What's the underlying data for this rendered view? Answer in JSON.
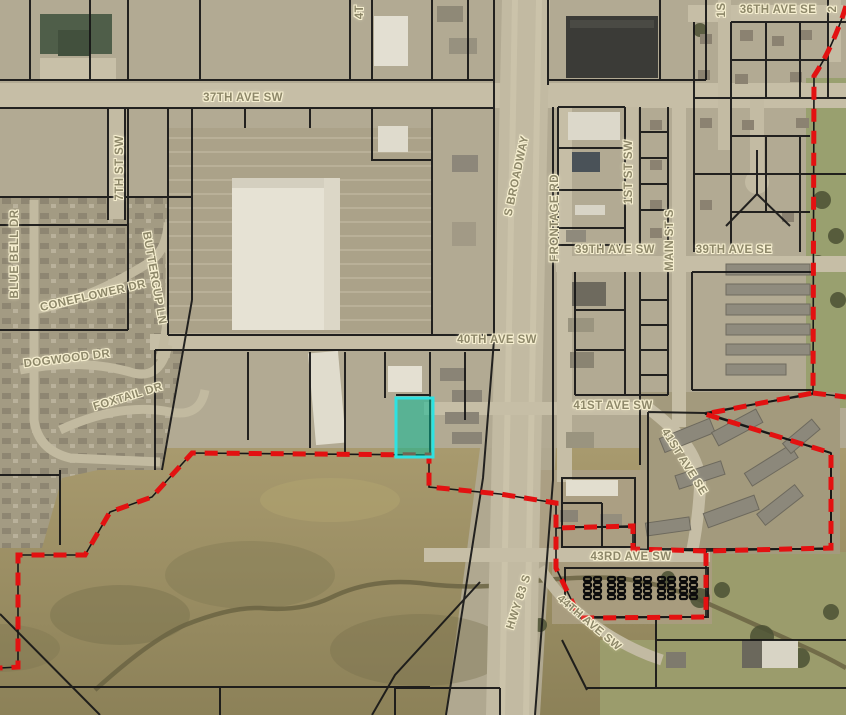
{
  "map": {
    "type": "parcel-aerial-map",
    "highlight_parcel": {
      "description": "selected parcel highlighted in cyan",
      "stroke_color": "#2ee2e2",
      "fill_color": "rgba(0,185,150,0.5)"
    },
    "boundary": {
      "description": "red dashed city-limit boundary",
      "color": "#e31111"
    },
    "parcel_line_color": "#161616",
    "label_text_color": "#8d8769",
    "label_halo_color": "#f6efd0"
  },
  "labels": [
    {
      "id": "37th-ave-sw",
      "text": "37TH AVE SW"
    },
    {
      "id": "4th-st-partial",
      "text": "4T"
    },
    {
      "id": "36th-ave-se",
      "text": "36TH AVE SE"
    },
    {
      "id": "1st-st-se-partial",
      "text": "1S"
    },
    {
      "id": "2nd-st-se-partial",
      "text": "2"
    },
    {
      "id": "s-broadway",
      "text": "S BROADWAY"
    },
    {
      "id": "frontage-rd",
      "text": "FRONTAGE RD"
    },
    {
      "id": "1st-st-sw",
      "text": "1ST ST SW"
    },
    {
      "id": "main-st-s",
      "text": "MAIN ST S"
    },
    {
      "id": "39th-ave-sw",
      "text": "39TH AVE SW"
    },
    {
      "id": "39th-ave-se",
      "text": "39TH AVE SE"
    },
    {
      "id": "7th-st-sw",
      "text": "7TH ST SW"
    },
    {
      "id": "blue-bell-dr",
      "text": "BLUE BELL DR"
    },
    {
      "id": "buttercup-ln",
      "text": "BUTTERCUP LN"
    },
    {
      "id": "coneflower-dr",
      "text": "CONEFLOWER DR"
    },
    {
      "id": "dogwood-dr",
      "text": "DOGWOOD DR"
    },
    {
      "id": "foxtail-dr",
      "text": "FOXTAIL DR"
    },
    {
      "id": "40th-ave-sw",
      "text": "40TH AVE SW"
    },
    {
      "id": "41st-ave-sw",
      "text": "41ST AVE SW"
    },
    {
      "id": "41st-ave-se",
      "text": "41ST AVE SE"
    },
    {
      "id": "43rd-ave-sw",
      "text": "43RD AVE SW"
    },
    {
      "id": "hwy-83-s",
      "text": "HWY 83 S"
    },
    {
      "id": "44th-ave-sw",
      "text": "44TH AVE SW"
    }
  ]
}
